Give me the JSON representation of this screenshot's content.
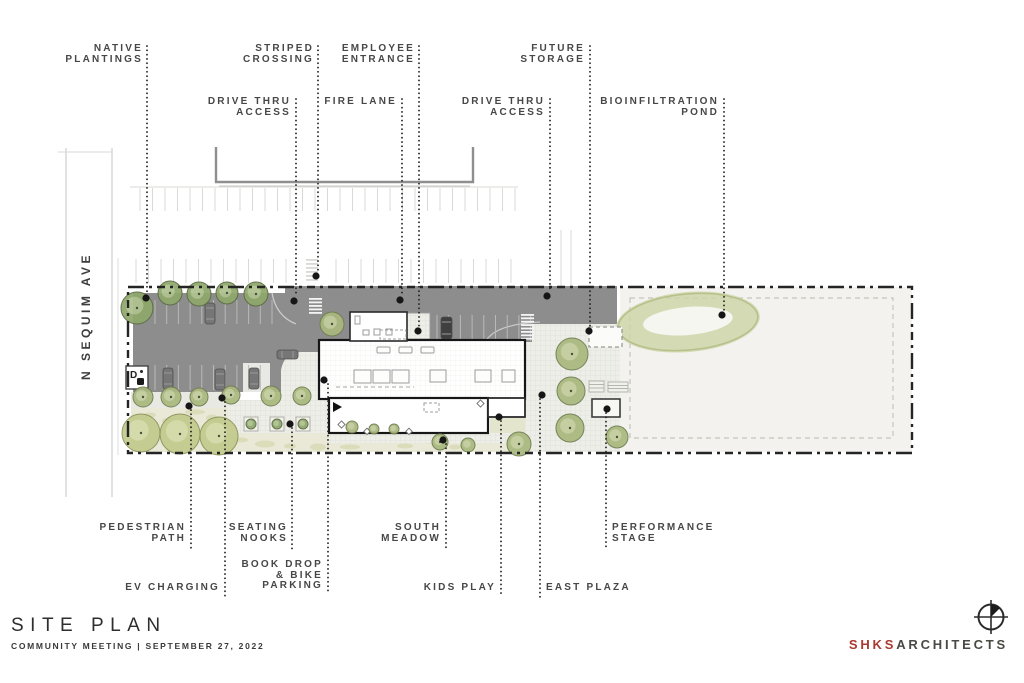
{
  "title_block": {
    "title": "SITE PLAN",
    "subtitle": "COMMUNITY MEETING | SEPTEMBER 27, 2022"
  },
  "street": {
    "name": "N SEQUIM AVE"
  },
  "logo": {
    "firm_short": "SHKS",
    "firm_rest": "ARCHITECTS",
    "mark": "compass-benchmark-icon"
  },
  "plan_marks": {
    "accessible_sign": "D"
  },
  "colors": {
    "asphalt": "#8d8d8d",
    "label_text": "#474747",
    "boundary": "#242424",
    "accent_red": "#a93a31",
    "tree_street": "#8fa76b",
    "tree_meadow": "#c3ca8d",
    "meadow_wash": "#eae9d8"
  },
  "annotations": [
    {
      "id": "native-plantings",
      "lines": [
        "NATIVE",
        "PLANTINGS"
      ]
    },
    {
      "id": "striped-crossing",
      "lines": [
        "STRIPED",
        "CROSSING"
      ]
    },
    {
      "id": "employee-entrance",
      "lines": [
        "EMPLOYEE",
        "ENTRANCE"
      ]
    },
    {
      "id": "future-storage",
      "lines": [
        "FUTURE",
        "STORAGE"
      ]
    },
    {
      "id": "drive-thru-access-west",
      "lines": [
        "DRIVE THRU",
        "ACCESS"
      ]
    },
    {
      "id": "fire-lane",
      "lines": [
        "FIRE LANE"
      ]
    },
    {
      "id": "drive-thru-access-east",
      "lines": [
        "DRIVE THRU",
        "ACCESS"
      ]
    },
    {
      "id": "bioinfiltration-pond",
      "lines": [
        "BIOINFILTRATION",
        "POND"
      ]
    },
    {
      "id": "pedestrian-path",
      "lines": [
        "PEDESTRIAN",
        "PATH"
      ]
    },
    {
      "id": "seating-nooks",
      "lines": [
        "SEATING",
        "NOOKS"
      ]
    },
    {
      "id": "south-meadow",
      "lines": [
        "SOUTH",
        "MEADOW"
      ]
    },
    {
      "id": "performance-stage",
      "lines": [
        "PERFORMANCE",
        "STAGE"
      ]
    },
    {
      "id": "ev-charging",
      "lines": [
        "EV CHARGING"
      ]
    },
    {
      "id": "book-drop-bike-parking",
      "lines": [
        "BOOK DROP",
        "& BIKE",
        "PARKING"
      ]
    },
    {
      "id": "kids-play",
      "lines": [
        "KIDS PLAY"
      ]
    },
    {
      "id": "east-plaza",
      "lines": [
        "EAST PLAZA"
      ]
    }
  ]
}
